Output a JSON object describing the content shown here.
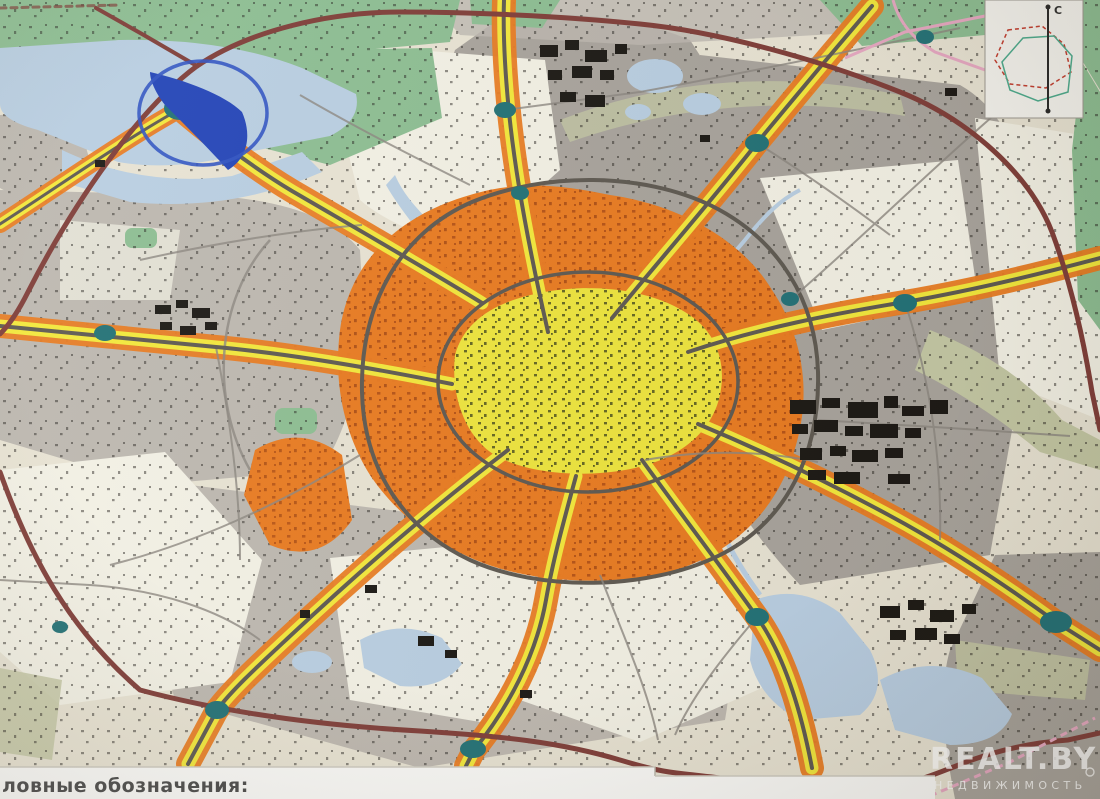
{
  "meta": {
    "description": "Photographed urban master-plan map of a city with radial corridors and ring roads"
  },
  "palette": {
    "paper": "#e9e4d4",
    "topo": "#f4f2e6",
    "urban_gray": "#a7a29b",
    "urban_gray2": "#bdb8b0",
    "forest": "#8cbd92",
    "sage": "#c4c8a4",
    "water": "#b9cfe3",
    "deep_blue": "#1f41b5",
    "circle_blue": "#2c50c0",
    "core_yellow": "#efe63c",
    "corridor_yellow": "#f4e93a",
    "zone_orange": "#e8791e",
    "road_dark": "#5b564e",
    "road_minor": "#8a857e",
    "mkad": "#7c3a35",
    "junction_teal": "#1e6f74",
    "pink": "#e7a8c2",
    "industrial_black": "#16130f",
    "strip_white": "#fcfcfa",
    "legend_text": "#474747",
    "watermark": "#ffffff"
  },
  "legend": {
    "label": "ловные обозначения:"
  },
  "watermark": {
    "brand": "REALT.BY",
    "subtitle": "НЕДВИЖИМОСТЬ"
  },
  "compass": {
    "north_label": "С"
  },
  "map": {
    "type": "urban master plan",
    "zones": [
      {
        "name": "city-core",
        "color": "#efe63c"
      },
      {
        "name": "mid-city-belt",
        "color": "#e8791e"
      },
      {
        "name": "urban-fabric",
        "color": "#a7a29b"
      },
      {
        "name": "suburban-topo",
        "color": "#f4f2e6"
      },
      {
        "name": "forest",
        "color": "#8cbd92"
      },
      {
        "name": "water",
        "color": "#b9cfe3"
      }
    ],
    "annotations": [
      {
        "name": "reservoir-highlight-circle",
        "color": "#2c50c0"
      },
      {
        "name": "reservoir-wedge",
        "color": "#1f41b5"
      },
      {
        "name": "ring-road",
        "color": "#7c3a35"
      }
    ]
  }
}
